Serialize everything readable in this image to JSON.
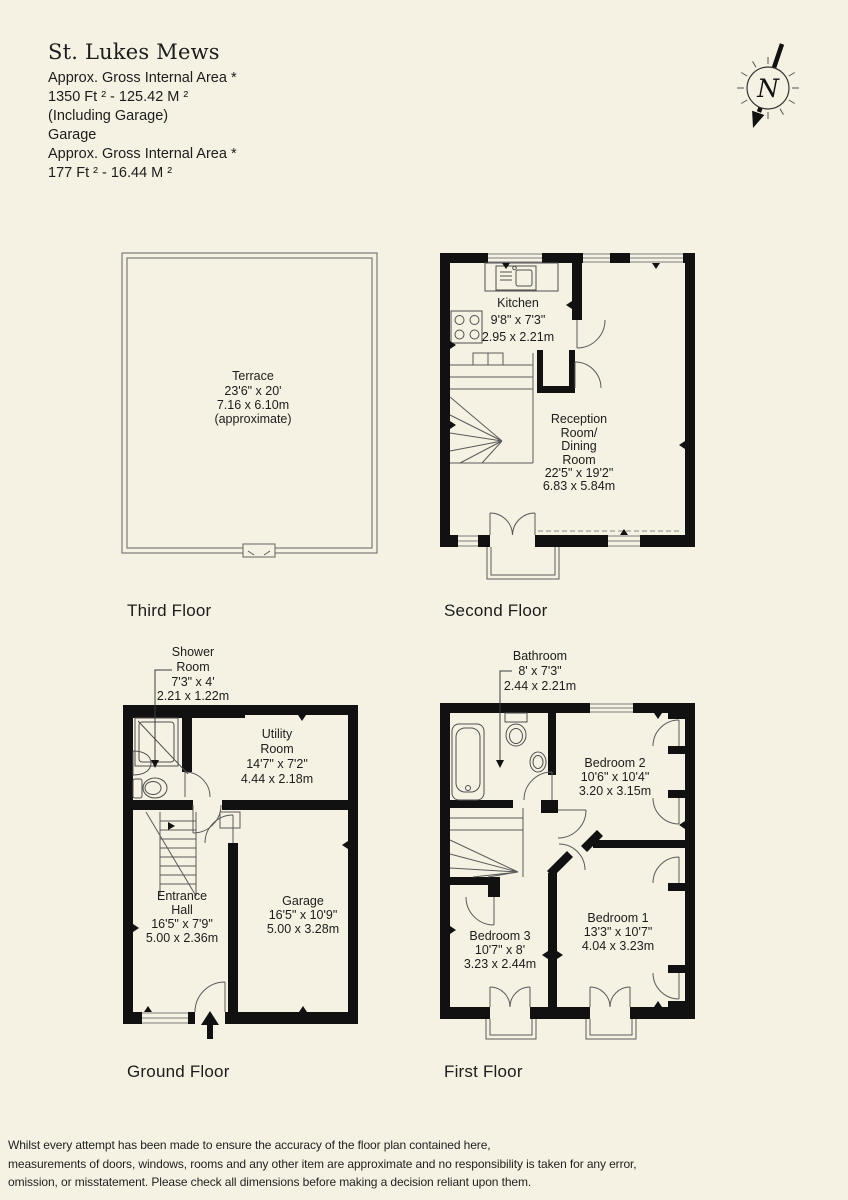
{
  "header": {
    "title": "St. Lukes Mews",
    "lines": [
      "Approx. Gross Internal Area *",
      "1350 Ft ²  -  125.42 M ²",
      "(Including Garage)",
      "Garage",
      "Approx. Gross Internal Area *",
      "177 Ft ²  -  16.44 M ²"
    ]
  },
  "compass": {
    "label": "N"
  },
  "floors": {
    "third": {
      "label": "Third Floor",
      "terrace": [
        "Terrace",
        "23'6\" x 20'",
        "7.16 x 6.10m",
        "(approximate)"
      ]
    },
    "second": {
      "label": "Second Floor",
      "kitchen": [
        "Kitchen",
        "9'8\" x 7'3\"",
        "2.95 x 2.21m"
      ],
      "reception": [
        "Reception",
        "Room/",
        "Dining",
        "Room",
        "22'5\" x 19'2\"",
        "6.83 x 5.84m"
      ]
    },
    "ground": {
      "label": "Ground Floor",
      "shower": [
        "Shower",
        "Room",
        "7'3\" x 4'",
        "2.21 x 1.22m"
      ],
      "utility": [
        "Utility",
        "Room",
        "14'7\" x 7'2\"",
        "4.44 x 2.18m"
      ],
      "entrance": [
        "Entrance",
        "Hall",
        "16'5\" x 7'9\"",
        "5.00 x 2.36m"
      ],
      "garage": [
        "Garage",
        "16'5\" x 10'9\"",
        "5.00 x 3.28m"
      ]
    },
    "first": {
      "label": "First Floor",
      "bathroom": [
        "Bathroom",
        "8' x 7'3\"",
        "2.44 x 2.21m"
      ],
      "bedroom2": [
        "Bedroom 2",
        "10'6\" x 10'4\"",
        "3.20 x 3.15m"
      ],
      "bedroom1": [
        "Bedroom 1",
        "13'3\" x 10'7\"",
        "4.04 x 3.23m"
      ],
      "bedroom3": [
        "Bedroom 3",
        "10'7\" x 8'",
        "3.23 x 2.44m"
      ]
    }
  },
  "footer": {
    "lines": [
      "Whilst every attempt has been made to ensure the accuracy of the floor plan contained here,",
      "measurements of doors, windows, rooms and any other item are approximate and no responsibility is taken for any error,",
      "omission, or misstatement. Please check all dimensions before making a decision reliant upon them."
    ]
  },
  "colors": {
    "background": "#f5f2e3",
    "wall": "#111111",
    "line": "#5a5a5a",
    "text": "#1c1c1c"
  }
}
